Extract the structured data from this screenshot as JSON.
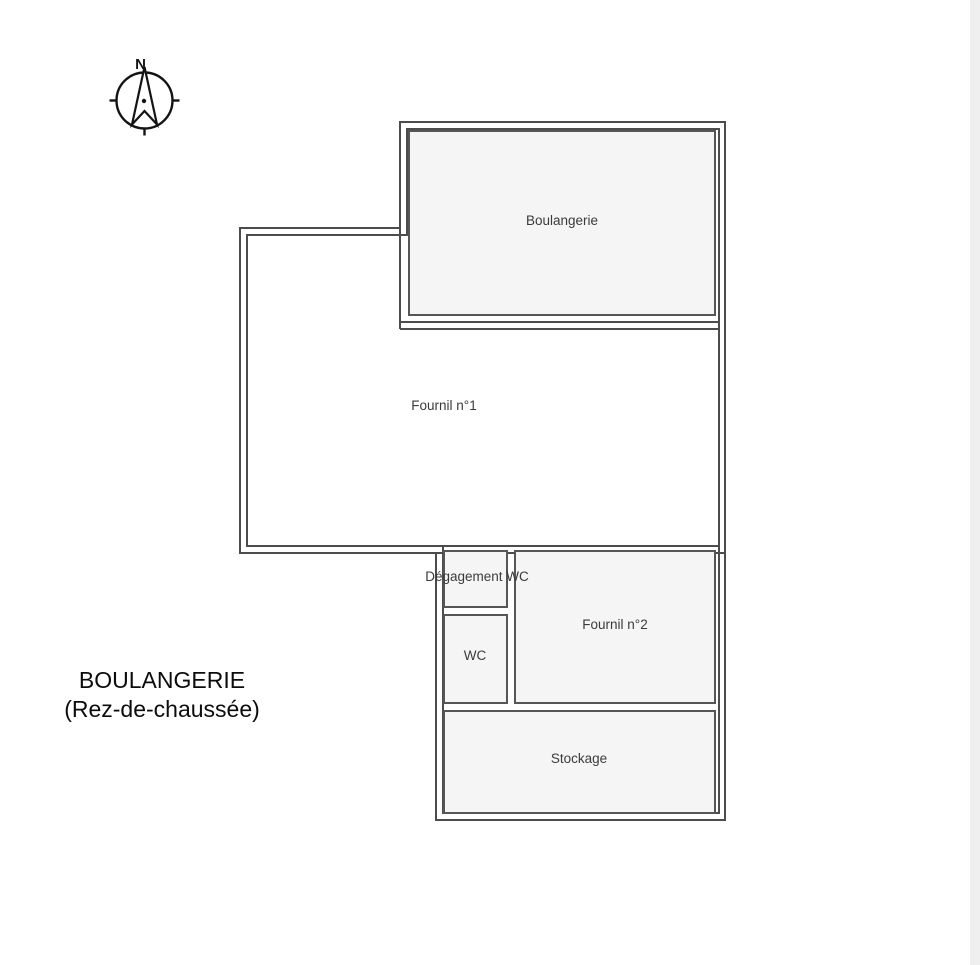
{
  "document": {
    "title_line1": "BOULANGERIE",
    "title_line2": "(Rez-de-chaussée)"
  },
  "compass": {
    "north_label": "N"
  },
  "floor_plan": {
    "rooms": [
      {
        "id": "boulangerie",
        "label": "Boulangerie"
      },
      {
        "id": "fournil-1",
        "label": "Fournil n°1"
      },
      {
        "id": "degagement-wc",
        "label": "Dégagement WC"
      },
      {
        "id": "wc",
        "label": "WC"
      },
      {
        "id": "fournil-2",
        "label": "Fournil n°2"
      },
      {
        "id": "stockage",
        "label": "Stockage"
      }
    ]
  },
  "colors": {
    "background": "#ffffff",
    "wall": "#4c4c4c",
    "room_border": "#565656",
    "room_fill": "#f5f5f5",
    "room_label": "#3b3b3b",
    "title_text": "#0c0c0c",
    "compass": "#141414",
    "right_edge_strip": "#efefef"
  }
}
